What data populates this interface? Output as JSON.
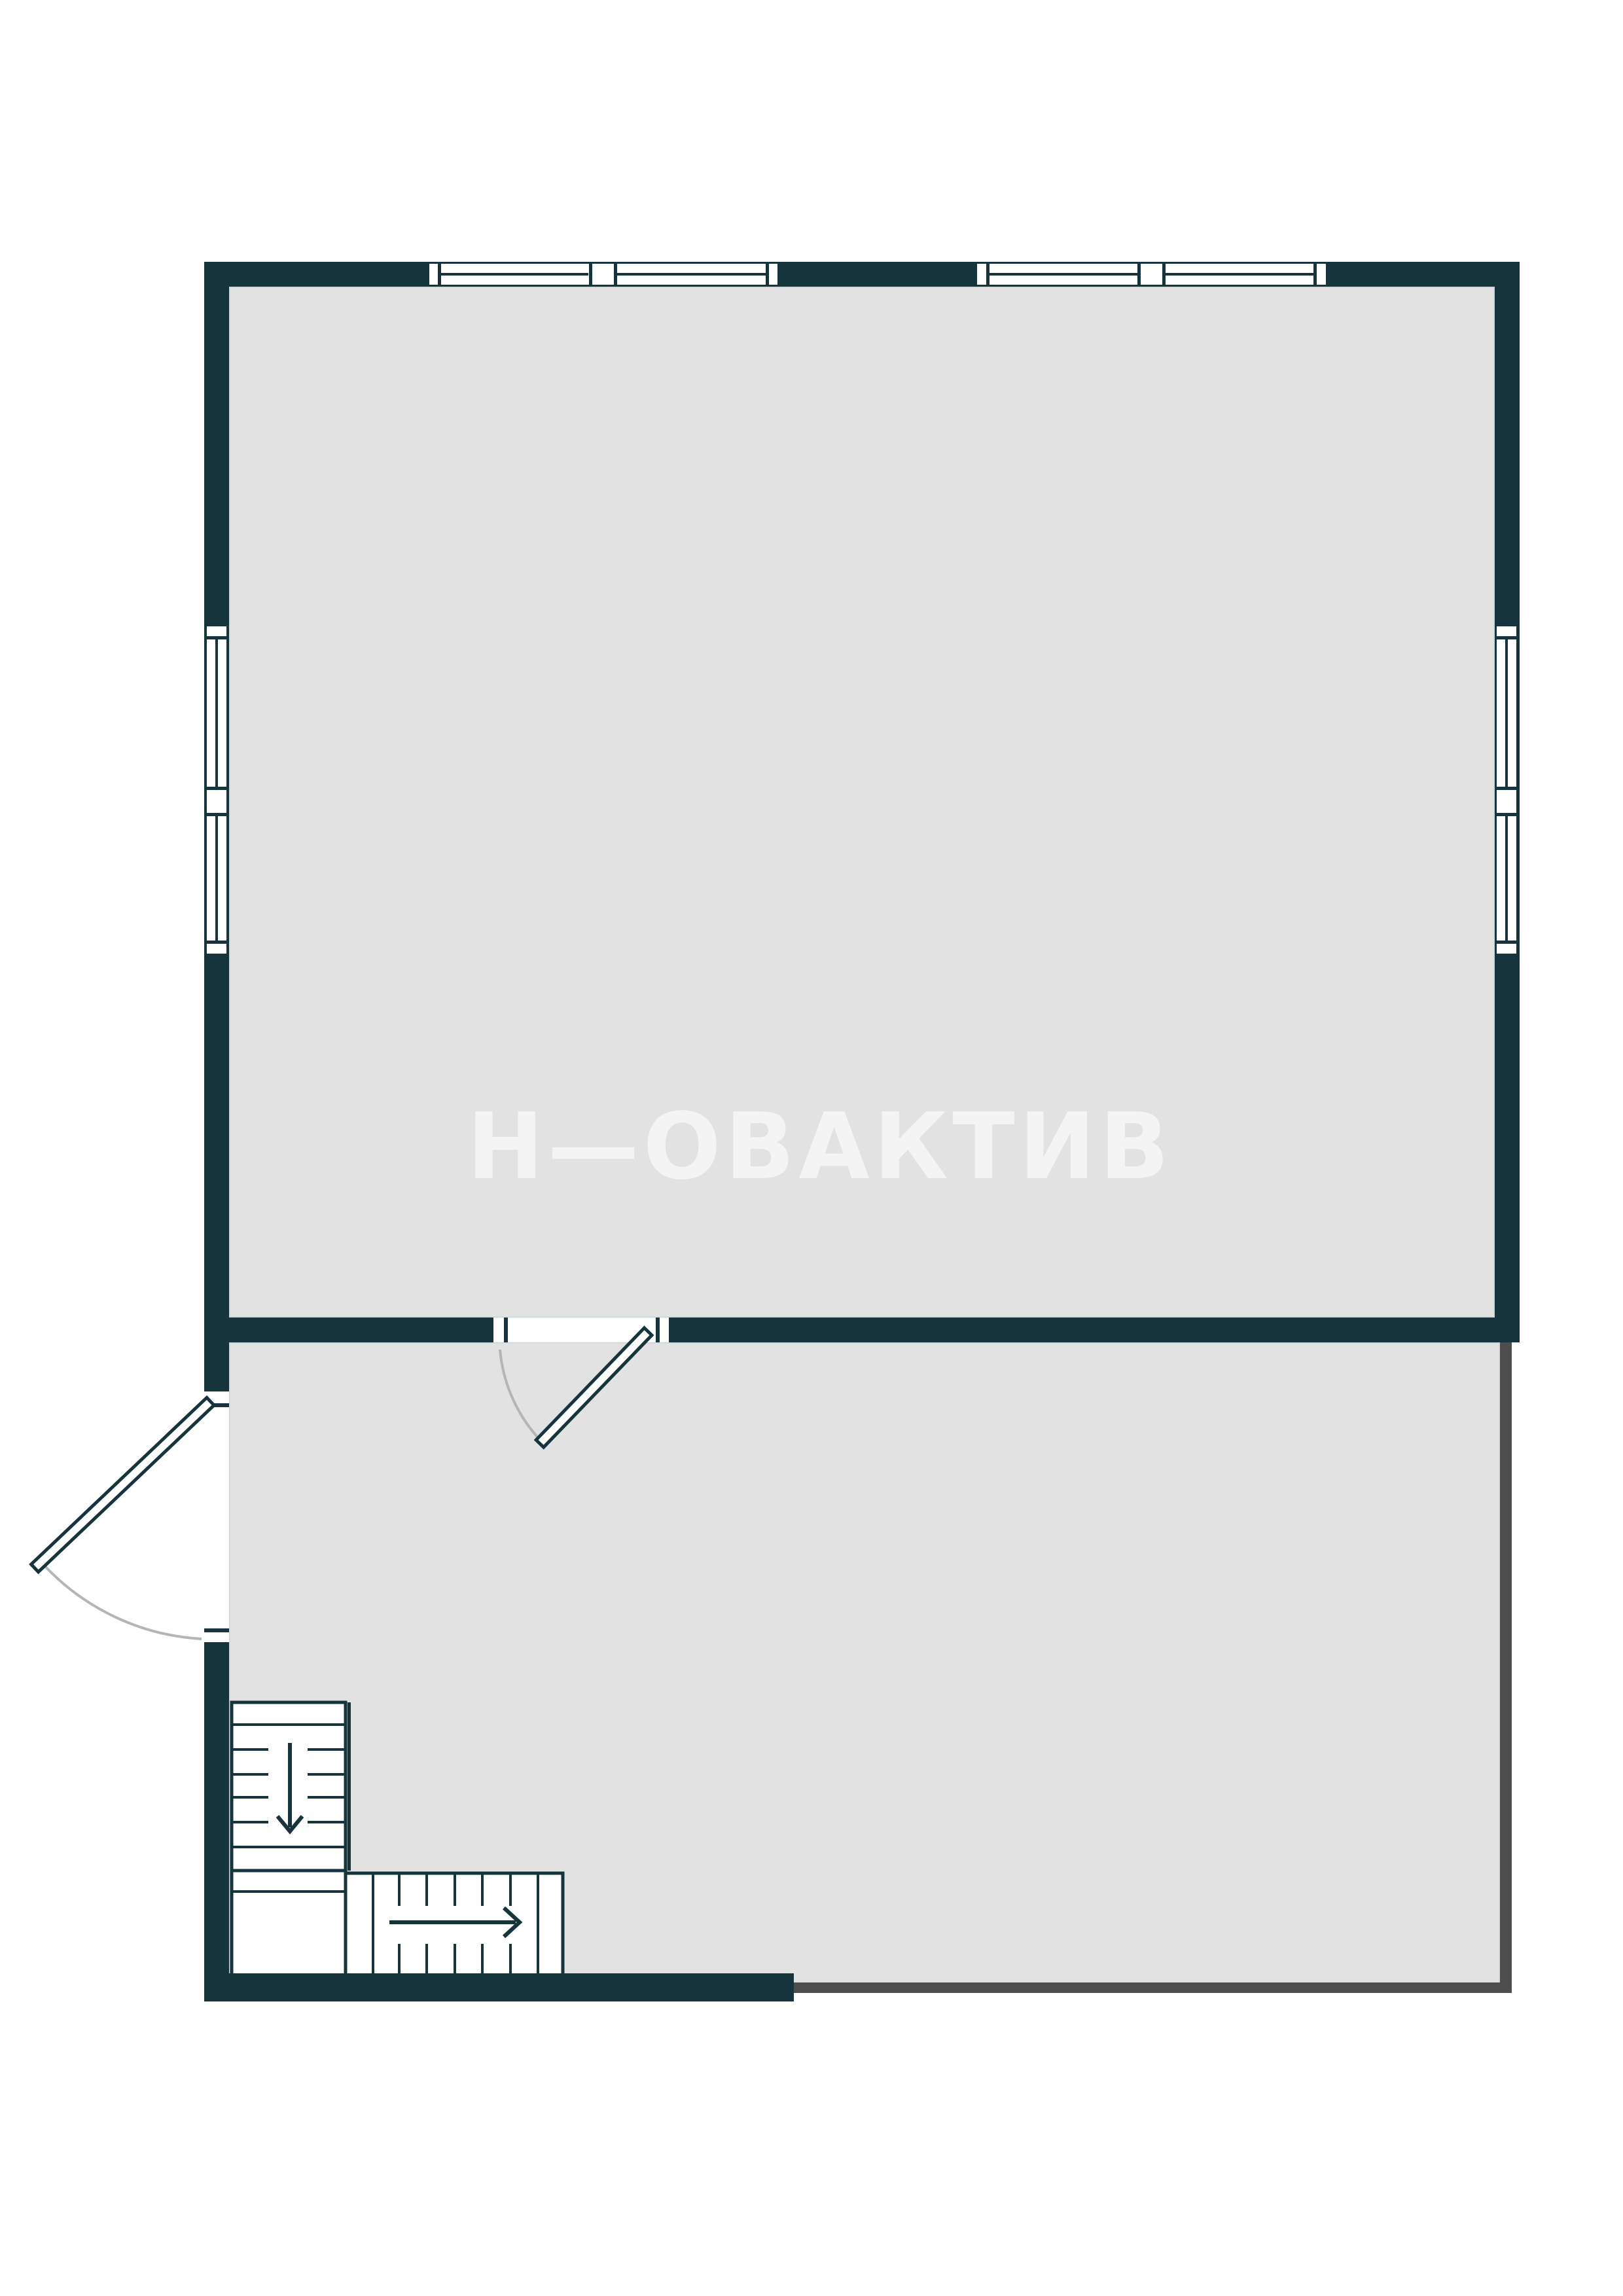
{
  "watermark": {
    "brand": "НОВАКТИВ",
    "brand_display": "Н—ОВАКТИВ"
  },
  "colors": {
    "background": "#ffffff",
    "wall": "#16343c",
    "floor": "#e2e2e3",
    "edge": "#c9d5d7",
    "thin": "#4d4d4d",
    "arc": "#b2b6b6",
    "white": "#ffffff",
    "watermark": "#ffffff"
  },
  "plan": {
    "type": "floor-plan",
    "rooms": [
      {
        "name": "upper-room"
      },
      {
        "name": "lower-room"
      }
    ],
    "windows": {
      "top_wall_groups": 2,
      "sashes_per_group": 2,
      "left_wall_double_window": 1,
      "right_wall_double_window": 1
    },
    "doors": [
      {
        "name": "interior-door",
        "location": "wall between rooms",
        "swing": "into lower room"
      },
      {
        "name": "exterior-door",
        "location": "lower-left wall",
        "swing": "outward"
      }
    ],
    "stairs": {
      "flights": 2,
      "upper_flight_arrow": "down",
      "lower_flight_arrow": "right"
    }
  }
}
